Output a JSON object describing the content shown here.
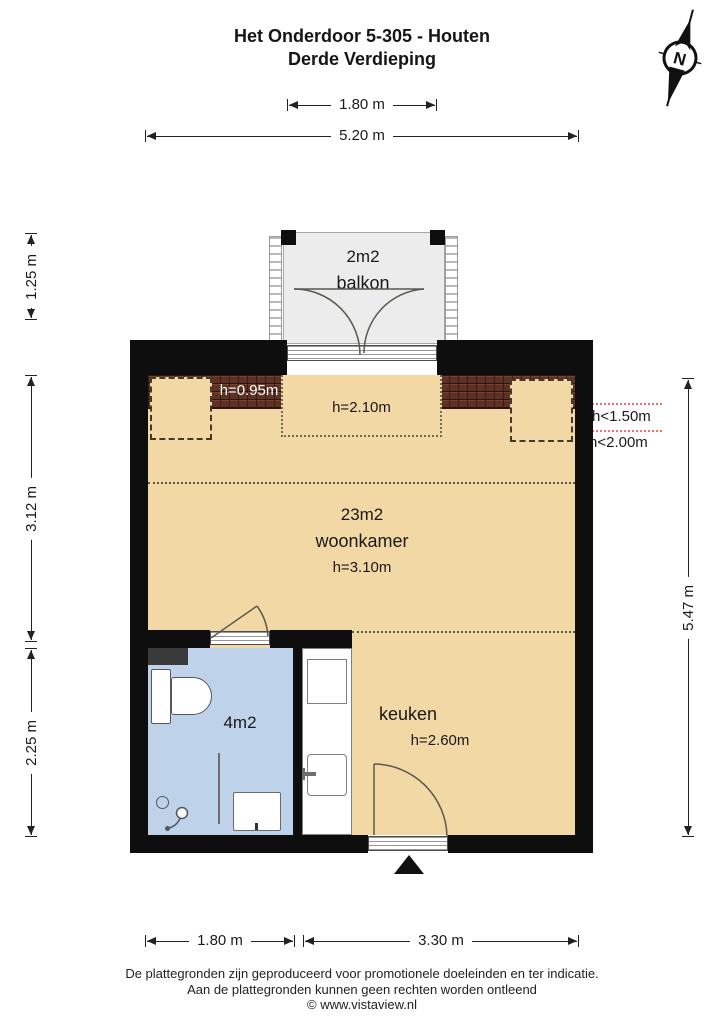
{
  "title": {
    "line1": "Het Onderdoor 5-305 - Houten",
    "line2": "Derde Verdieping"
  },
  "compass": {
    "label": "N"
  },
  "dims": {
    "top_balcony": "1.80 m",
    "top_total": "5.20 m",
    "left_balcony": "1.25 m",
    "left_living": "3.12 m",
    "left_bath": "2.25 m",
    "right_total": "5.47 m",
    "bottom_bath": "1.80 m",
    "bottom_kitchen": "3.30 m"
  },
  "height_markers": {
    "line1": "h<1.50m",
    "line2": "h<2.00m"
  },
  "rooms": {
    "balkon": {
      "area": "2m2",
      "name": "balkon"
    },
    "woonkamer": {
      "area": "23m2",
      "name": "woonkamer",
      "height": "h=3.10m",
      "height_edge": "h=0.95m",
      "height_mid": "h=2.10m"
    },
    "badkamer": {
      "area": "4m2"
    },
    "keuken": {
      "name": "keuken",
      "height": "h=2.60m"
    }
  },
  "footer": {
    "line1": "De plattegronden zijn geproduceerd voor promotionele doeleinden en ter indicatie.",
    "line2": "Aan de plattegronden kunnen geen rechten worden ontleend",
    "line3": "© www.vistaview.nl"
  },
  "colors": {
    "floor": "#f2d8a4",
    "bathroom": "#bed3ea",
    "balcony": "#ececec",
    "roof_tiles": "#5d3123",
    "wall": "#0e0e0e",
    "height_marker": "#f07070"
  }
}
